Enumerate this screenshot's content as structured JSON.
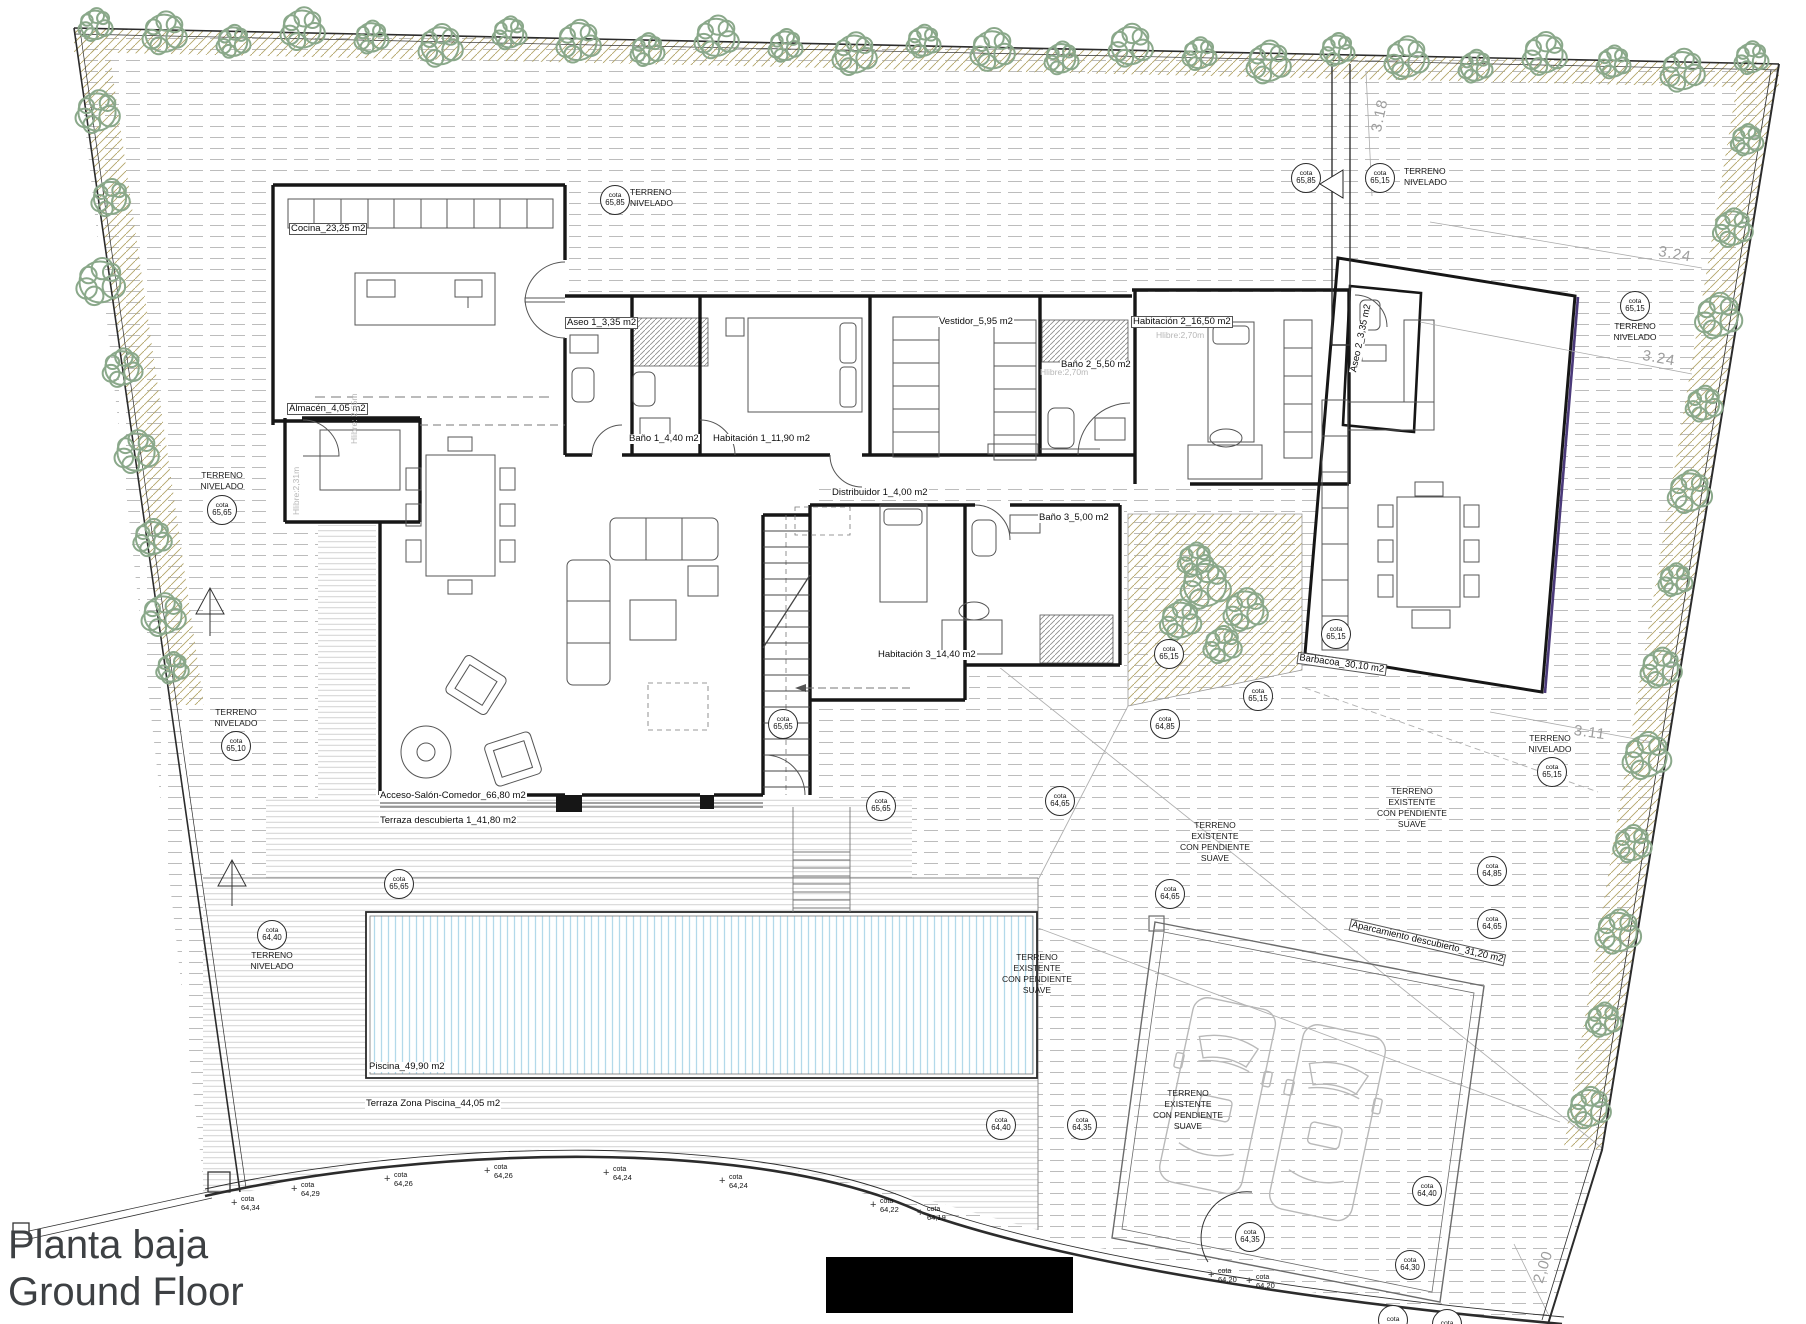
{
  "title": {
    "line1": "Planta baja",
    "line2": "Ground Floor"
  },
  "cota_word": "cota",
  "colors": {
    "tree": "#8aa88a",
    "edge_hatch": "#b3a469",
    "pool_lines": "#b3d9ea",
    "terrain_lines": "#bcbcbc",
    "deck_lines": "#cccccc",
    "wall": "#161616",
    "dim_text": "#9d9d9d",
    "gray_text": "#b7b7b7",
    "accent_wall": "#4b3a7a"
  },
  "room_labels": [
    {
      "text": "Cocina_23,25 m2",
      "x": 290,
      "y": 224,
      "boxed": true
    },
    {
      "text": "Almacén_4,05 m2",
      "x": 288,
      "y": 404,
      "boxed": true
    },
    {
      "text": "Aseo 1_3,35 m2",
      "x": 566,
      "y": 318,
      "boxed": true
    },
    {
      "text": "Baño 1_4,40 m2",
      "x": 628,
      "y": 434,
      "boxed": false
    },
    {
      "text": "Habitación 1_11,90 m2",
      "x": 712,
      "y": 434,
      "boxed": false
    },
    {
      "text": "Vestidor_5,95 m2",
      "x": 938,
      "y": 317,
      "boxed": false
    },
    {
      "text": "Baño 2_5,50 m2",
      "x": 1060,
      "y": 360,
      "boxed": false
    },
    {
      "text": "Habitación 2_16,50 m2",
      "x": 1132,
      "y": 317,
      "boxed": true
    },
    {
      "text": "Distribuidor 1_4,00 m2",
      "x": 831,
      "y": 488,
      "boxed": false
    },
    {
      "text": "Baño 3_5,00 m2",
      "x": 1038,
      "y": 513,
      "boxed": false
    },
    {
      "text": "Habitación 3_14,40 m2",
      "x": 877,
      "y": 650,
      "boxed": false
    },
    {
      "text": "Acceso-Salón-Comedor_66,80 m2",
      "x": 379,
      "y": 791,
      "boxed": false
    },
    {
      "text": "Terraza descubierta 1_41,80 m2",
      "x": 379,
      "y": 816,
      "boxed": false
    },
    {
      "text": "Piscina_49,90 m2",
      "x": 368,
      "y": 1062,
      "boxed": false
    },
    {
      "text": "Terraza Zona Piscina_44,05 m2",
      "x": 365,
      "y": 1099,
      "boxed": false
    },
    {
      "text": "Barbacoa_30,10 m2",
      "x": 1299,
      "y": 653,
      "boxed": true,
      "rot": 8
    },
    {
      "text": "Aseo 2_3,35 m2",
      "x": 1349,
      "y": 372,
      "boxed": false,
      "rot": -78
    },
    {
      "text": "Aparcamiento descubierto_31,20 m2",
      "x": 1352,
      "y": 920,
      "boxed": true,
      "rot": 13
    }
  ],
  "gray_labels": [
    {
      "text": "Hlibre: 2,65m",
      "x": 349,
      "y": 444,
      "rot": -90
    },
    {
      "text": "Hlibre:2,31m",
      "x": 291,
      "y": 515,
      "rot": -90
    },
    {
      "text": "Hlibre:2,70m",
      "x": 1156,
      "y": 330,
      "rot": 0
    },
    {
      "text": "Hlibre:2,70m",
      "x": 1040,
      "y": 367,
      "rot": 0
    }
  ],
  "terrain_labels": [
    {
      "lines": [
        "TERRENO",
        "NIVELADO"
      ],
      "x": 630,
      "y": 187,
      "align": "left"
    },
    {
      "lines": [
        "TERRENO",
        "NIVELADO"
      ],
      "x": 1404,
      "y": 166,
      "align": "left"
    },
    {
      "lines": [
        "TERRENO",
        "NIVELADO"
      ],
      "x": 1635,
      "y": 321,
      "align": "center"
    },
    {
      "lines": [
        "TERRENO",
        "NIVELADO"
      ],
      "x": 222,
      "y": 470,
      "align": "center"
    },
    {
      "lines": [
        "TERRENO",
        "NIVELADO"
      ],
      "x": 236,
      "y": 707,
      "align": "center"
    },
    {
      "lines": [
        "TERRENO",
        "NIVELADO"
      ],
      "x": 272,
      "y": 950,
      "align": "center"
    },
    {
      "lines": [
        "TERRENO",
        "NIVELADO"
      ],
      "x": 1550,
      "y": 733,
      "align": "center"
    },
    {
      "lines": [
        "TERRENO",
        "EXISTENTE",
        "CON PENDIENTE",
        "SUAVE"
      ],
      "x": 1215,
      "y": 820,
      "align": "center"
    },
    {
      "lines": [
        "TERRENO",
        "EXISTENTE",
        "CON PENDIENTE",
        "SUAVE"
      ],
      "x": 1412,
      "y": 786,
      "align": "center"
    },
    {
      "lines": [
        "TERRENO",
        "EXISTENTE",
        "CON PENDIENTE",
        "SUAVE"
      ],
      "x": 1037,
      "y": 952,
      "align": "center"
    },
    {
      "lines": [
        "TERRENO",
        "EXISTENTE",
        "CON PENDIENTE",
        "SUAVE"
      ],
      "x": 1188,
      "y": 1088,
      "align": "center"
    }
  ],
  "circle_cotas": [
    {
      "v": "65,85",
      "x": 615,
      "y": 200
    },
    {
      "v": "65,85",
      "x": 1306,
      "y": 178
    },
    {
      "v": "65,15",
      "x": 1380,
      "y": 178
    },
    {
      "v": "65,15",
      "x": 1635,
      "y": 306
    },
    {
      "v": "65,65",
      "x": 222,
      "y": 510
    },
    {
      "v": "65,10",
      "x": 236,
      "y": 746
    },
    {
      "v": "64,40",
      "x": 272,
      "y": 935
    },
    {
      "v": "65,65",
      "x": 399,
      "y": 884
    },
    {
      "v": "65,65",
      "x": 783,
      "y": 724
    },
    {
      "v": "65,65",
      "x": 881,
      "y": 806
    },
    {
      "v": "64,65",
      "x": 1060,
      "y": 801
    },
    {
      "v": "65,15",
      "x": 1169,
      "y": 654
    },
    {
      "v": "65,15",
      "x": 1258,
      "y": 696
    },
    {
      "v": "64,85",
      "x": 1165,
      "y": 724
    },
    {
      "v": "65,15",
      "x": 1336,
      "y": 634
    },
    {
      "v": "65,15",
      "x": 1552,
      "y": 772
    },
    {
      "v": "64,85",
      "x": 1492,
      "y": 871
    },
    {
      "v": "64,65",
      "x": 1492,
      "y": 924
    },
    {
      "v": "64,65",
      "x": 1170,
      "y": 894
    },
    {
      "v": "64,40",
      "x": 1001,
      "y": 1125
    },
    {
      "v": "64,35",
      "x": 1082,
      "y": 1125
    },
    {
      "v": "64,40",
      "x": 1427,
      "y": 1191
    },
    {
      "v": "64,35",
      "x": 1250,
      "y": 1237
    },
    {
      "v": "64,30",
      "x": 1410,
      "y": 1265
    },
    {
      "v": "",
      "x": 1393,
      "y": 1320,
      "partial": true
    },
    {
      "v": "",
      "x": 1447,
      "y": 1324,
      "partial": true
    }
  ],
  "cross_cotas": [
    {
      "v": "64,34",
      "x": 237,
      "y": 1200
    },
    {
      "v": "64,29",
      "x": 297,
      "y": 1186
    },
    {
      "v": "64,26",
      "x": 390,
      "y": 1176
    },
    {
      "v": "64,26",
      "x": 490,
      "y": 1168
    },
    {
      "v": "64,24",
      "x": 609,
      "y": 1170
    },
    {
      "v": "64,24",
      "x": 725,
      "y": 1178
    },
    {
      "v": "64,22",
      "x": 876,
      "y": 1202
    },
    {
      "v": "64,19",
      "x": 923,
      "y": 1210
    },
    {
      "v": "64,20",
      "x": 1214,
      "y": 1272
    },
    {
      "v": "64,20",
      "x": 1252,
      "y": 1278
    }
  ],
  "dims": [
    {
      "text": "3.18",
      "x": 1368,
      "y": 130,
      "rot": -78
    },
    {
      "text": "3.24",
      "x": 1660,
      "y": 243,
      "rot": 10
    },
    {
      "text": "3.24",
      "x": 1644,
      "y": 347,
      "rot": 10
    },
    {
      "text": "3.11",
      "x": 1575,
      "y": 722,
      "rot": 8
    },
    {
      "text": "2,00",
      "x": 1530,
      "y": 1280,
      "rot": -72
    }
  ]
}
